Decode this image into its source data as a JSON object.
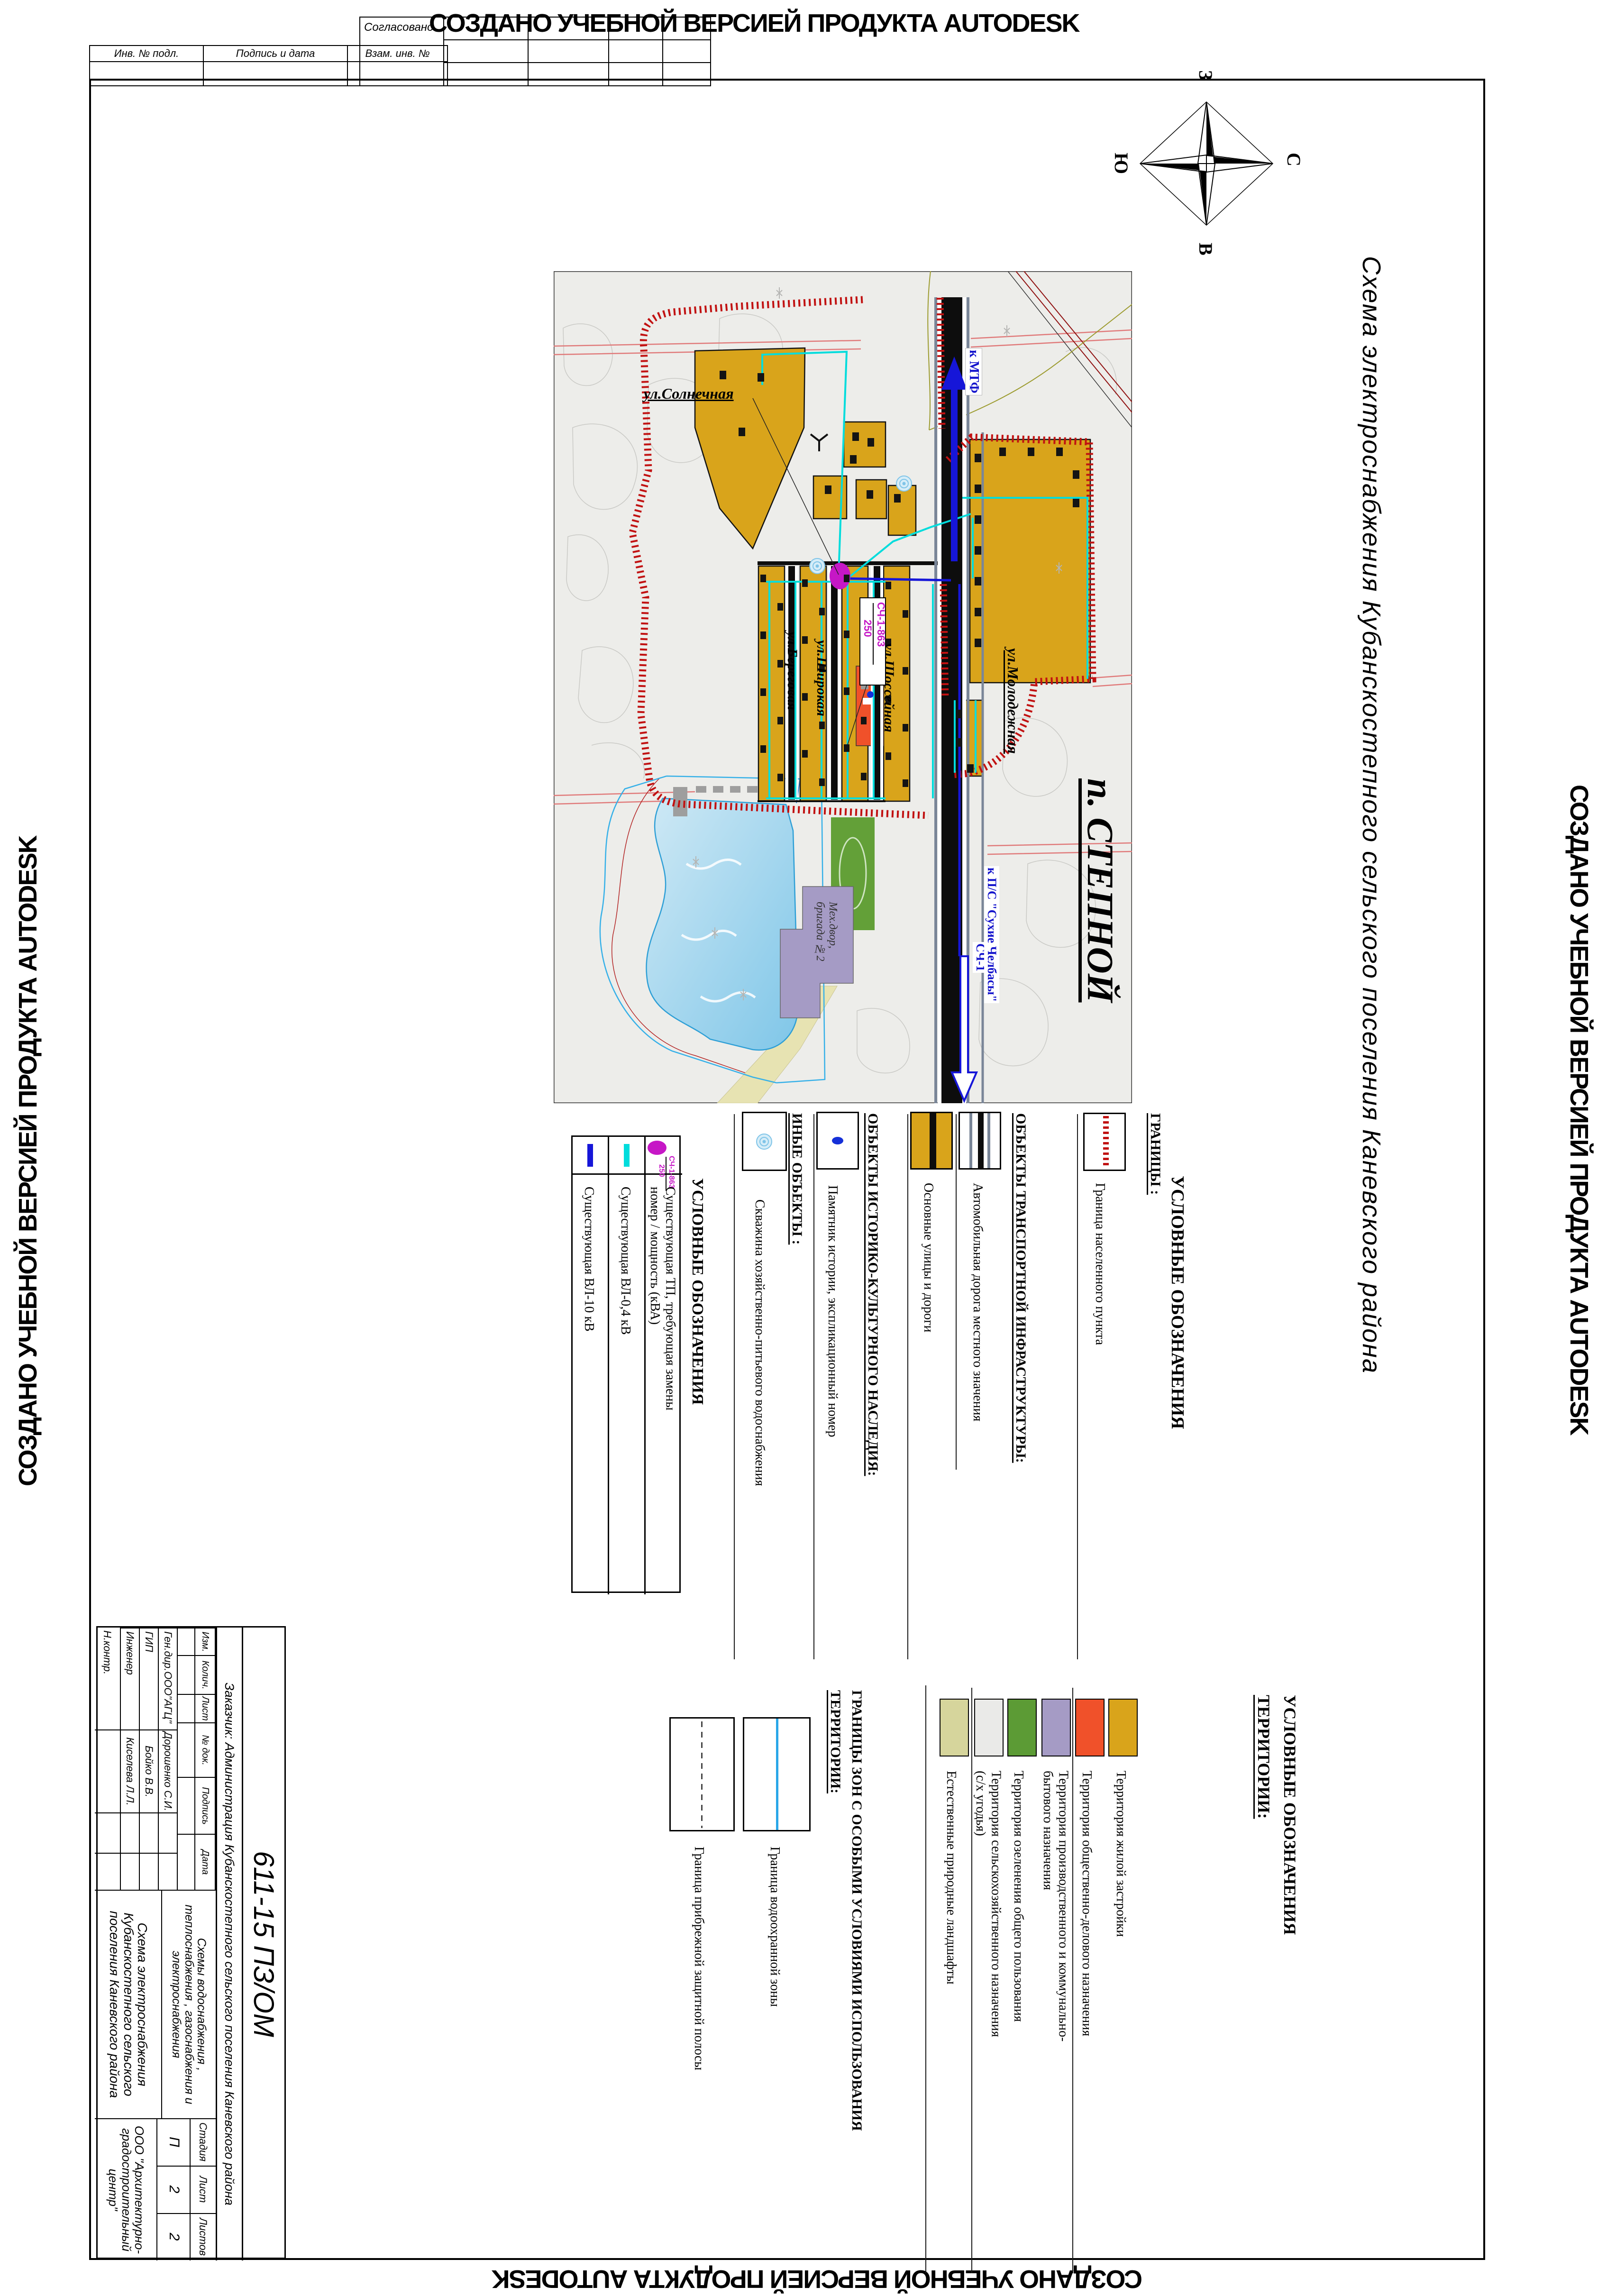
{
  "watermark": "СОЗДАНО УЧЕБНОЙ ВЕРСИЕЙ ПРОДУКТА AUTODESK",
  "colors": {
    "residential": "#D9A41B",
    "public_business": "#F0512A",
    "industrial": "#A59BC5",
    "greenery": "#5C9B35",
    "agricultural": "#EAEAE8",
    "natural": "#D6D59C",
    "vl10": "#1616D8",
    "vl04": "#00DCDC",
    "tp": "#C617C6",
    "boundary_hatch": "#C11212",
    "water": "#8FD0EC",
    "road_black": "#0D0D0D"
  },
  "sheet": {
    "title_vertical": "Схема электроснабжения Кубанскостепного сельского поселения Каневского района",
    "settlement_label": "п. СТЕПНОЙ"
  },
  "margin_stamps": {
    "inv_no": "Инв. № подл.",
    "sign_date": "Подпись и дата",
    "vzam_inv": "Взам. инв. №",
    "approved": "Согласовано"
  },
  "compass": {
    "top": "З",
    "bottom": "В",
    "left": "Ю",
    "right": "С"
  },
  "map": {
    "streets": {
      "solnechnaya": "ул.Солнечная",
      "beregovaya": "ул.Береговая",
      "shirokaya": "ул.Широкая",
      "shosseynaya": "ул.Шоссейная",
      "molodezhnaya": "ул.Молодежная"
    },
    "tp": {
      "num": "СЧ-1-863",
      "power": "250"
    },
    "to_mtf": "к МТФ",
    "line_name": "СЧ-1",
    "to_substation": "к П/С \"Сухие Челбасы\"",
    "meh_dvor": "Мех.двор,\nбригада №2"
  },
  "legend_top": {
    "heading": "УСЛОВНЫЕ ОБОЗНАЧЕНИЯ",
    "power": {
      "heading": "УСЛОВНЫЕ ОБОЗНАЧЕНИЯ",
      "items": [
        {
          "label": "Существующая ВЛ-10 кВ"
        },
        {
          "label": "Существующая ВЛ-0,4 кВ"
        },
        {
          "label": "Существующая  ТП, требующая замены\nномер / мощность (кВА)",
          "sym_num": "СЧ-1-863",
          "sym_pow": "250"
        }
      ]
    },
    "other": {
      "heading": "ИНЫЕ ОБЪЕКТЫ :",
      "label": "Скважина хозяйственно-питьевого водоснабжения"
    },
    "heritage": {
      "heading": "ОБЪЕКТЫ ИСТОРИКО-КУЛЬТУРНОГО НАСЛЕДИЯ:",
      "label": "Памятник истории, экспликационный номер"
    },
    "transport": {
      "heading": "ОБЪЕКТЫ ТРАНСПОРТНОЙ ИНФРАСТРУКТУРЫ:",
      "items": [
        {
          "label": "Основные улицы и дороги"
        },
        {
          "label": "Автомобильная дорога местного значения"
        }
      ]
    },
    "borders": {
      "heading": "ГРАНИЦЫ :",
      "label": "Граница населенного пункта"
    }
  },
  "legend_bottom": {
    "heading_line1": "УСЛОВНЫЕ ОБОЗНАЧЕНИЯ",
    "heading_line2": "ТЕРРИТОРИИ:",
    "territories": [
      {
        "label": "Территория жилой застройки",
        "color": "#D9A41B"
      },
      {
        "label": "Территория общественно-делового назначения",
        "color": "#F0512A"
      },
      {
        "label": "Территория производственного и коммунально-\nбытового назначения",
        "color": "#A59BC5"
      },
      {
        "label": "Территория озеленения общего пользования",
        "color": "#5C9B35"
      },
      {
        "label": "Территория сельскохозяйственного назначения\n(с/х угодья)",
        "color": "#EAEAE8"
      },
      {
        "label": "Естественные природные ландшафты",
        "color": "#D6D59C"
      }
    ],
    "zones": {
      "heading_line1": "ГРАНИЦЫ ЗОН С ОСОБЫМИ УСЛОВИЯМИ ИСПОЛЬЗОВАНИЯ",
      "heading_line2": "ТЕРРИТОРИИ:",
      "items": [
        {
          "label": "Граница водоохранной зоны"
        },
        {
          "label": "Граница прибрежной защитной полосы"
        }
      ]
    }
  },
  "titleblock": {
    "doc_number": "611-15 ПЗ/ОМ",
    "header_cells": [
      "Изм.",
      "Колич.",
      "Лист",
      "№ док.",
      "Подпись",
      "Дата"
    ],
    "staff": [
      {
        "role": "Ген.дир.ООО\"АГЦ\"",
        "name": "Дорошенко С.И."
      },
      {
        "role": "ГИП",
        "name": "Бойко В.В."
      },
      {
        "role": "Инженер",
        "name": "Киселева Л.Л."
      },
      {
        "role": "Н.контр.",
        "name": ""
      }
    ],
    "client": "Заказчик: Администрация Кубанскостепного сельского поселения Каневского района",
    "project": "Схемы водоснабжения ,  теплоснабжения , газоснабжения и электроснабжения",
    "sheet_name": "Схема электроснабжения Кубанскостепного сельского поселения Каневского района",
    "stage_label": "Стадия",
    "stage": "П",
    "list_label": "Лист",
    "list": "2",
    "listov_label": "Листов",
    "listov": "2",
    "org": "ООО \"Архитектурно-\nградостроительный центр\""
  }
}
